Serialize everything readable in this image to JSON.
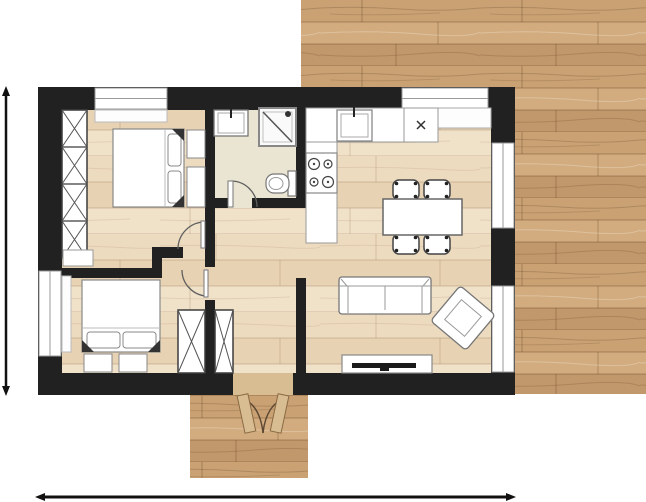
{
  "scene": {
    "kind": "apartment-floor-plan",
    "background": "#ffffff",
    "visible_text": []
  },
  "palette": {
    "wall": "#212121",
    "window_white": "#ffffff",
    "window_frame": "#9a9a9a",
    "furniture_fill": "#ffffff",
    "furniture_stroke": "#787878",
    "closet_stroke": "#3c3c3c",
    "dark_accent": "#1a1a1a",
    "bathroom_floor": "#eae4d2",
    "door_arc": "#5f5f5f",
    "door_leaf_wood": "#d8bd92",
    "entrance_leaf_stroke": "#5a4632",
    "dimension_line": "#111111",
    "outdoor_wood_tones": [
      "#c9a173",
      "#d2ac7e",
      "#c1986b"
    ],
    "indoor_wood_tones": [
      "#eddbc0",
      "#e7d2b3",
      "#f0e1c9"
    ]
  },
  "floor_plan": {
    "rooms": [
      {
        "id": "bedroom-1",
        "position": "top-left"
      },
      {
        "id": "bedroom-2",
        "position": "bottom-left"
      },
      {
        "id": "bathroom",
        "position": "top-center"
      },
      {
        "id": "hallway-vestibule",
        "position": "center"
      },
      {
        "id": "kitchen-living-room",
        "position": "right"
      },
      {
        "id": "entrance",
        "position": "bottom-center"
      }
    ],
    "windows_count": 5,
    "interior_doors_count": 4,
    "entrance_double_door": true,
    "furniture": [
      "wardrobe-4-cell",
      "double-bed-1",
      "nightstands-bed-1",
      "dresser-bed-1",
      "double-bed-2",
      "nightstands-bed-2",
      "hall-wardrobe-left",
      "hall-wardrobe-right",
      "bath-sink",
      "shower",
      "toilet",
      "kitchen-counter",
      "kitchen-sink",
      "kitchen-appliance",
      "stove-4-burners",
      "window-sill-counter",
      "dining-table",
      "dining-chairs-x4",
      "sofa",
      "armchair-rotated",
      "tv-bench"
    ],
    "dimension_lines": [
      {
        "id": "vertical-left",
        "arrows": "both-ends"
      },
      {
        "id": "horizontal-bottom",
        "arrows": "both-ends"
      }
    ]
  }
}
